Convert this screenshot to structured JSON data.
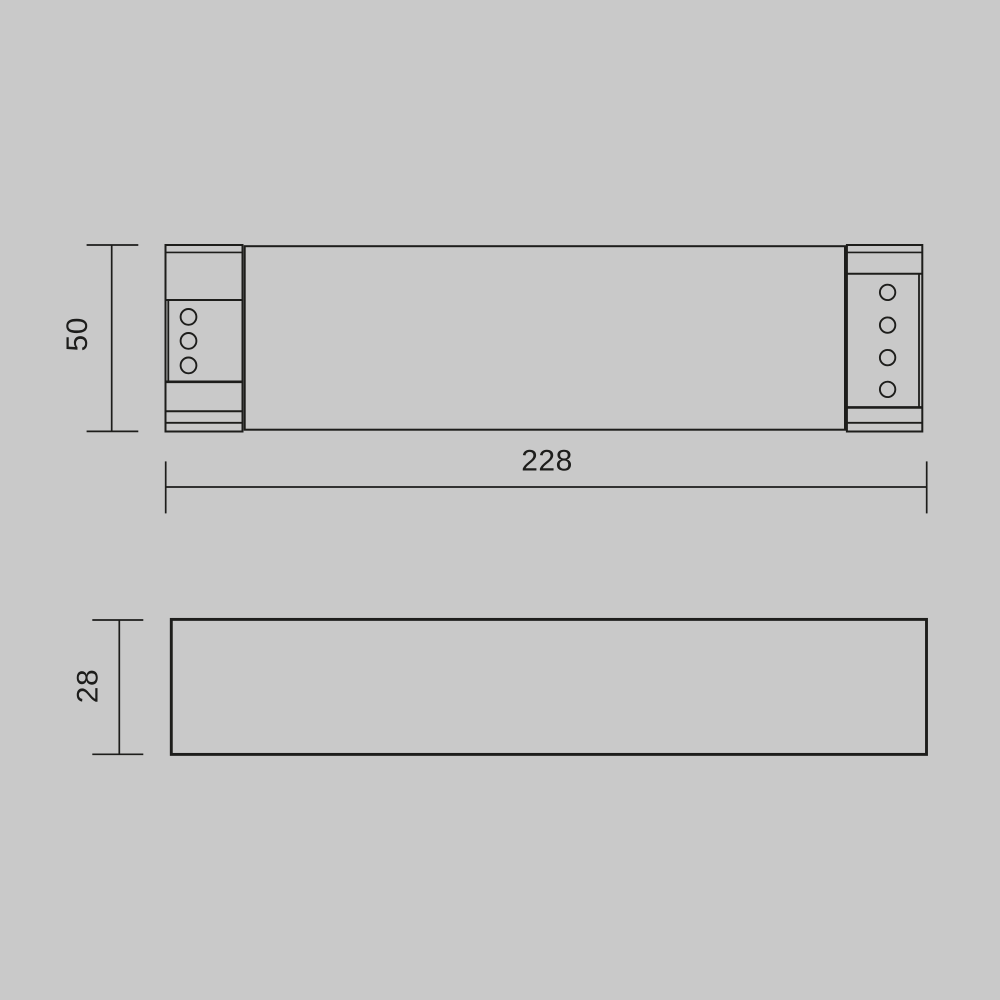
{
  "page": {
    "background_color": "#c9c9c9",
    "line_color": "#1d1d1b"
  },
  "drawing": {
    "kind": "technical-dimension-drawing",
    "views": {
      "top": {
        "name": "top view",
        "left_terminal_holes": 3,
        "right_terminal_holes": 4
      },
      "front": {
        "name": "front profile view"
      }
    },
    "dimensions": {
      "height": {
        "label": "50",
        "orientation": "vertical",
        "view": "top"
      },
      "length": {
        "label": "228",
        "orientation": "horizontal",
        "view": "top"
      },
      "depth": {
        "label": "28",
        "orientation": "vertical",
        "view": "front"
      }
    }
  }
}
